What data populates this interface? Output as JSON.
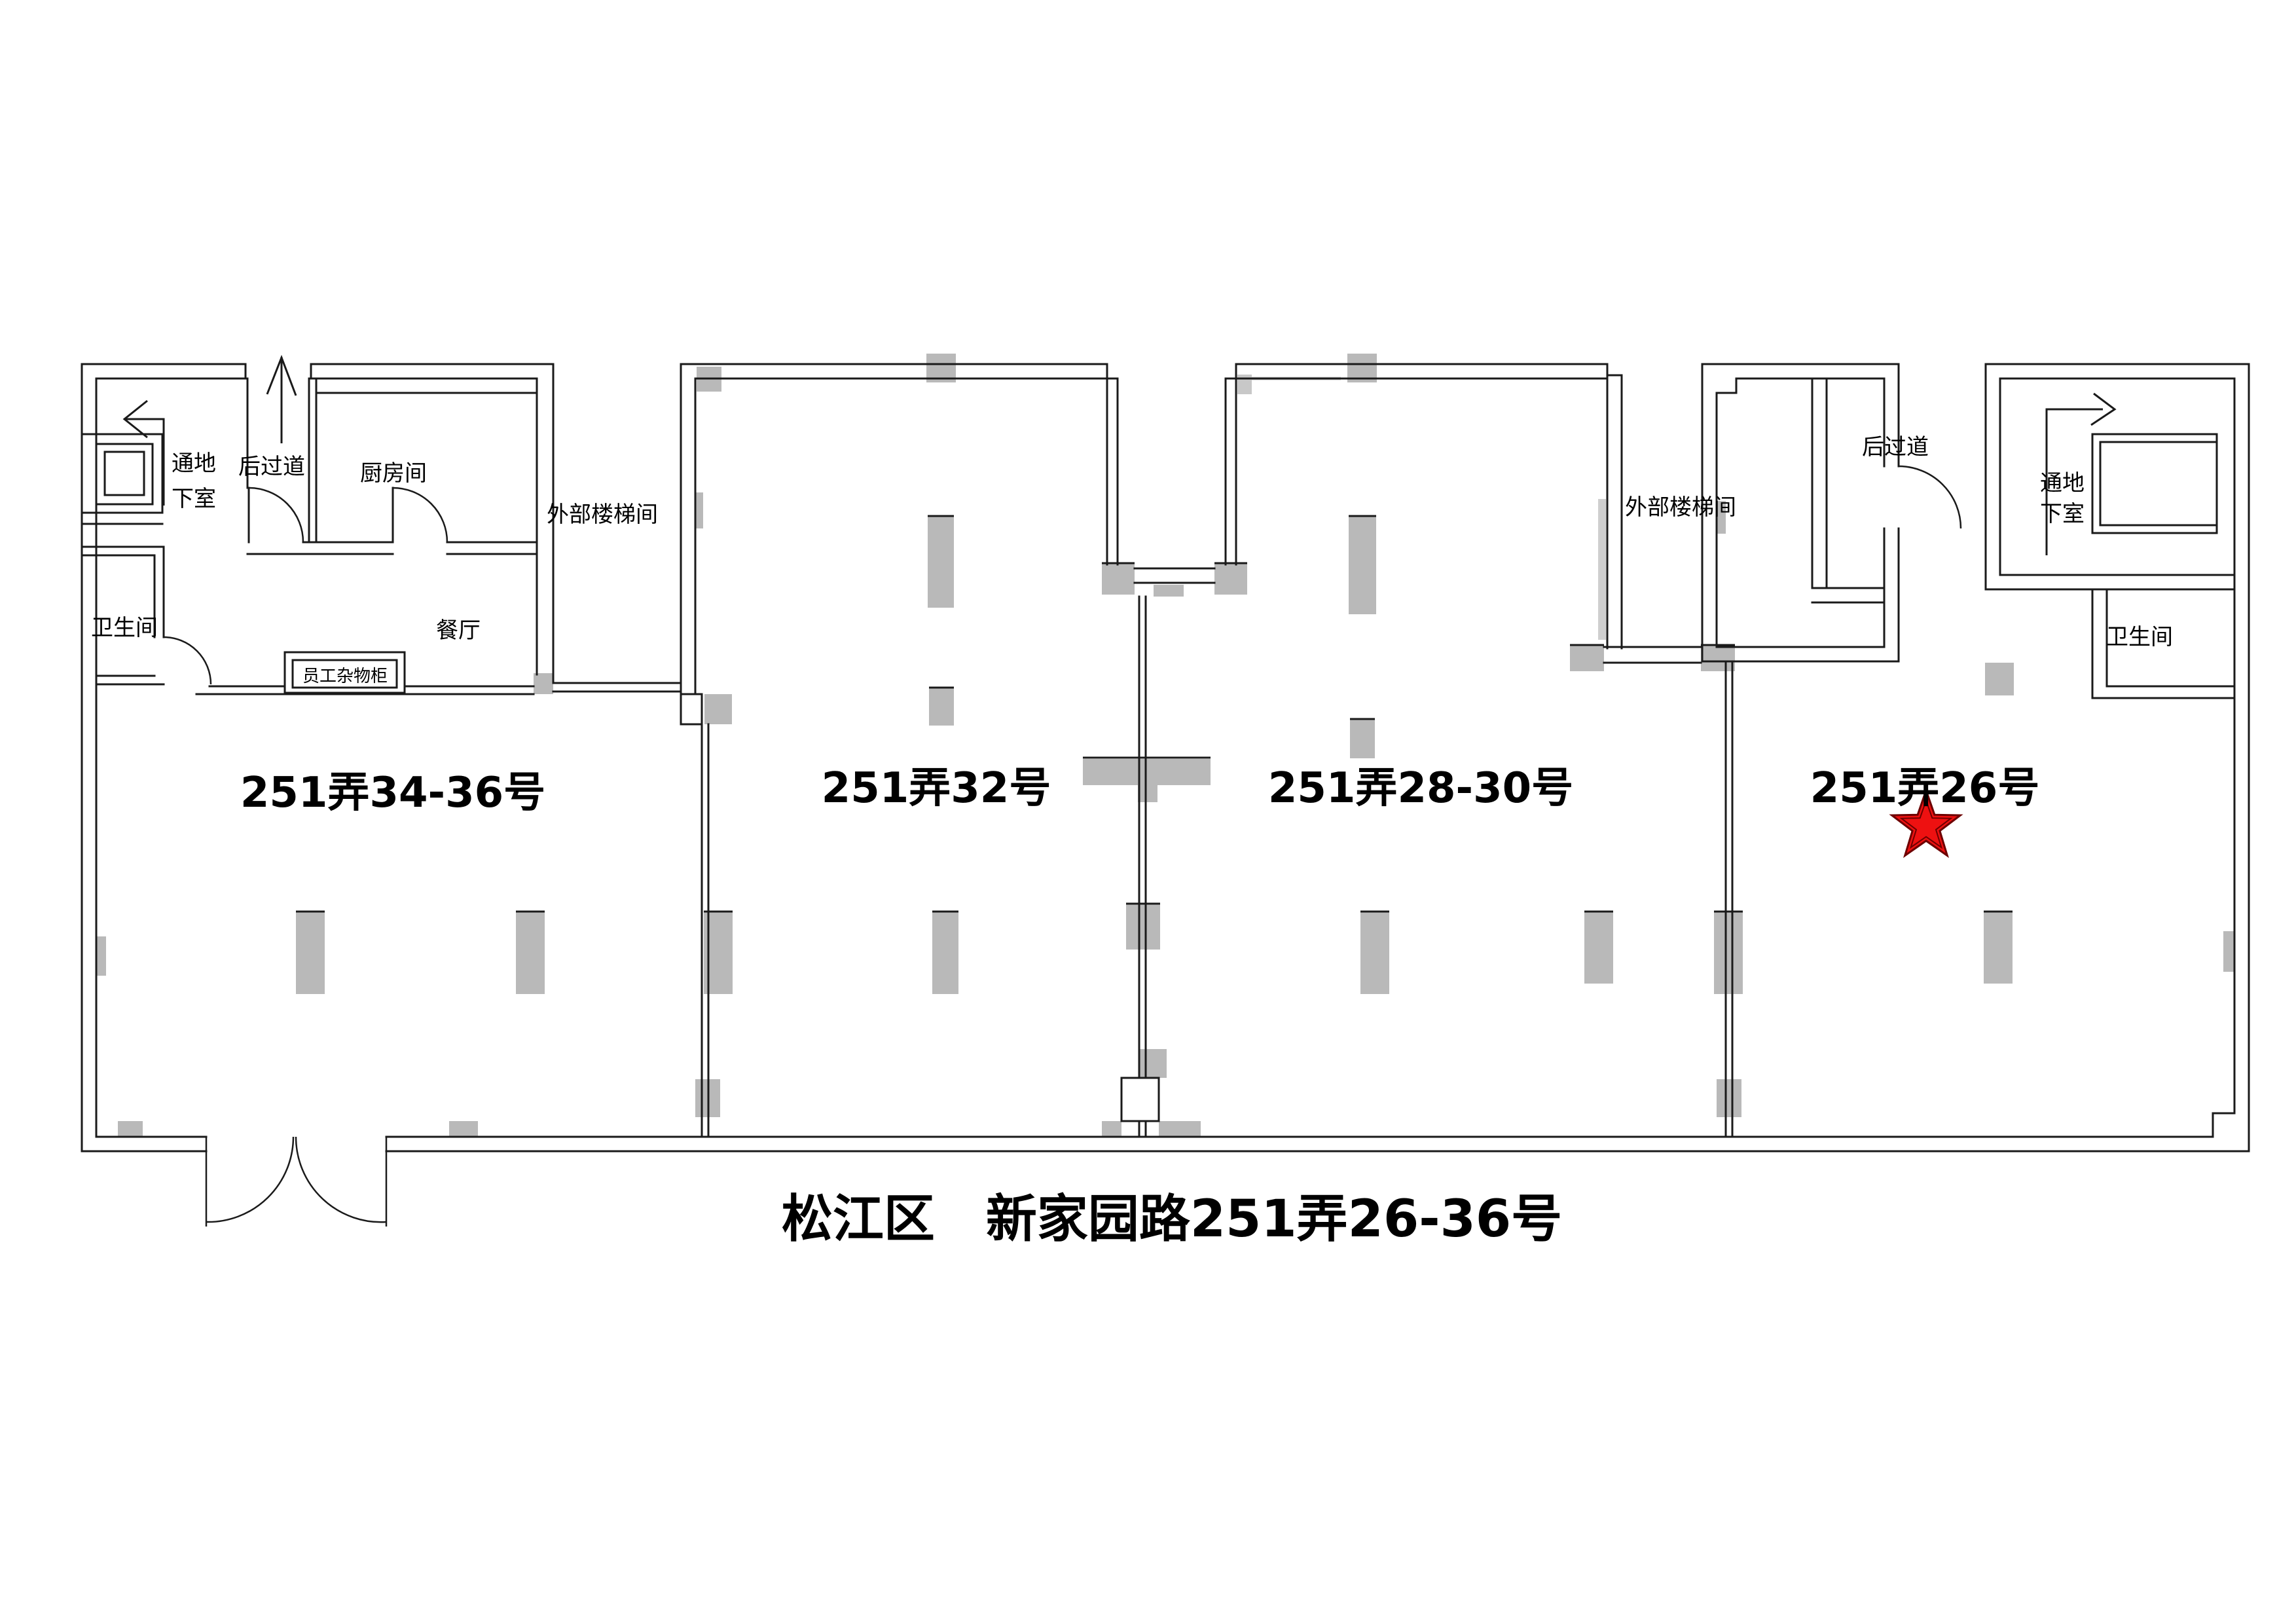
{
  "title": "松江区　新家园路251弄26-36号",
  "units": [
    {
      "id": "34-36",
      "label": "251弄34-36号"
    },
    {
      "id": "32",
      "label": "251弄32号"
    },
    {
      "id": "28-30",
      "label": "251弄28-30号"
    },
    {
      "id": "26",
      "label": "251弄26号",
      "marked": true
    }
  ],
  "room_labels": {
    "back_corridor": "后过道",
    "kitchen": "厨房间",
    "bathroom": "卫生间",
    "dining_room": "餐厅",
    "staff_locker": "员工杂物柜",
    "external_stairwell": "外部楼梯间",
    "to_basement_line1": "通地",
    "to_basement_line2": "下室"
  },
  "marker": {
    "shape": "star",
    "color": "#ee1111",
    "marks_unit": "251弄26号"
  },
  "colors": {
    "wall": "#1a1a1a",
    "pillar": "#b9b9b9",
    "background": "#ffffff"
  }
}
